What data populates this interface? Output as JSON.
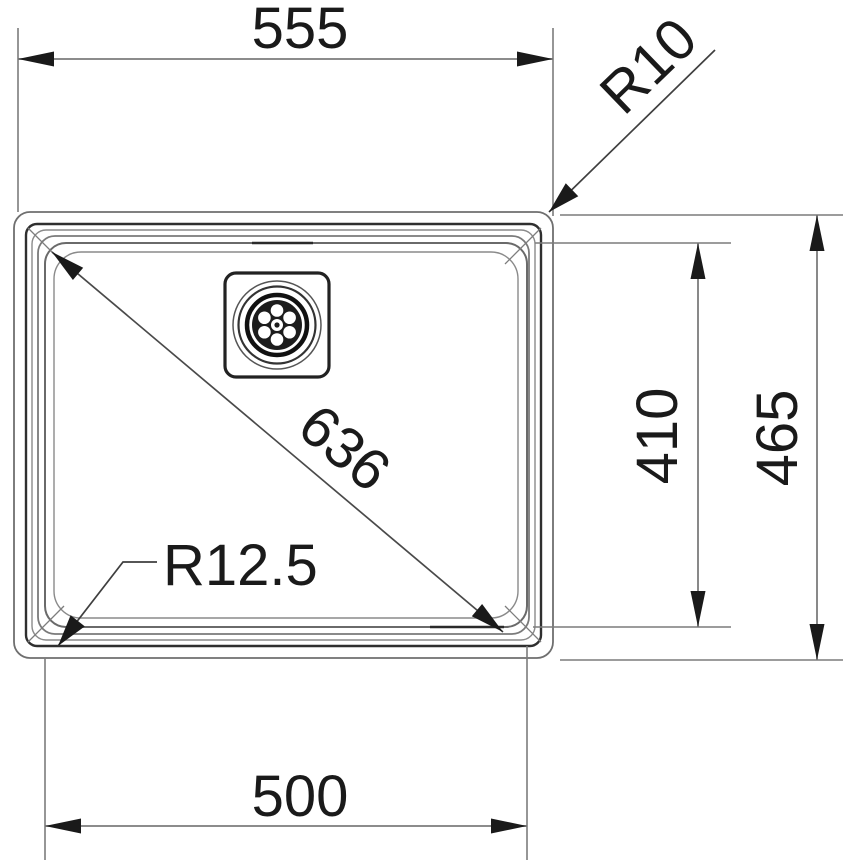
{
  "drawing": {
    "subject": "kitchen-sink-plan-view-technical-drawing",
    "labels": {
      "overall_width": "555",
      "bowl_width": "500",
      "overall_depth": "465",
      "bowl_depth": "410",
      "diagonal": "636",
      "radius_outer": "R10",
      "radius_bowl": "R12.5"
    },
    "colors": {
      "background": "#ffffff",
      "dimension_line": "#7c7c7c",
      "leader_line": "#3f3f3f",
      "outline_dark": "#2f2f2f",
      "outline_gray": "#8a8a8a",
      "text": "#1a1a1a"
    }
  }
}
